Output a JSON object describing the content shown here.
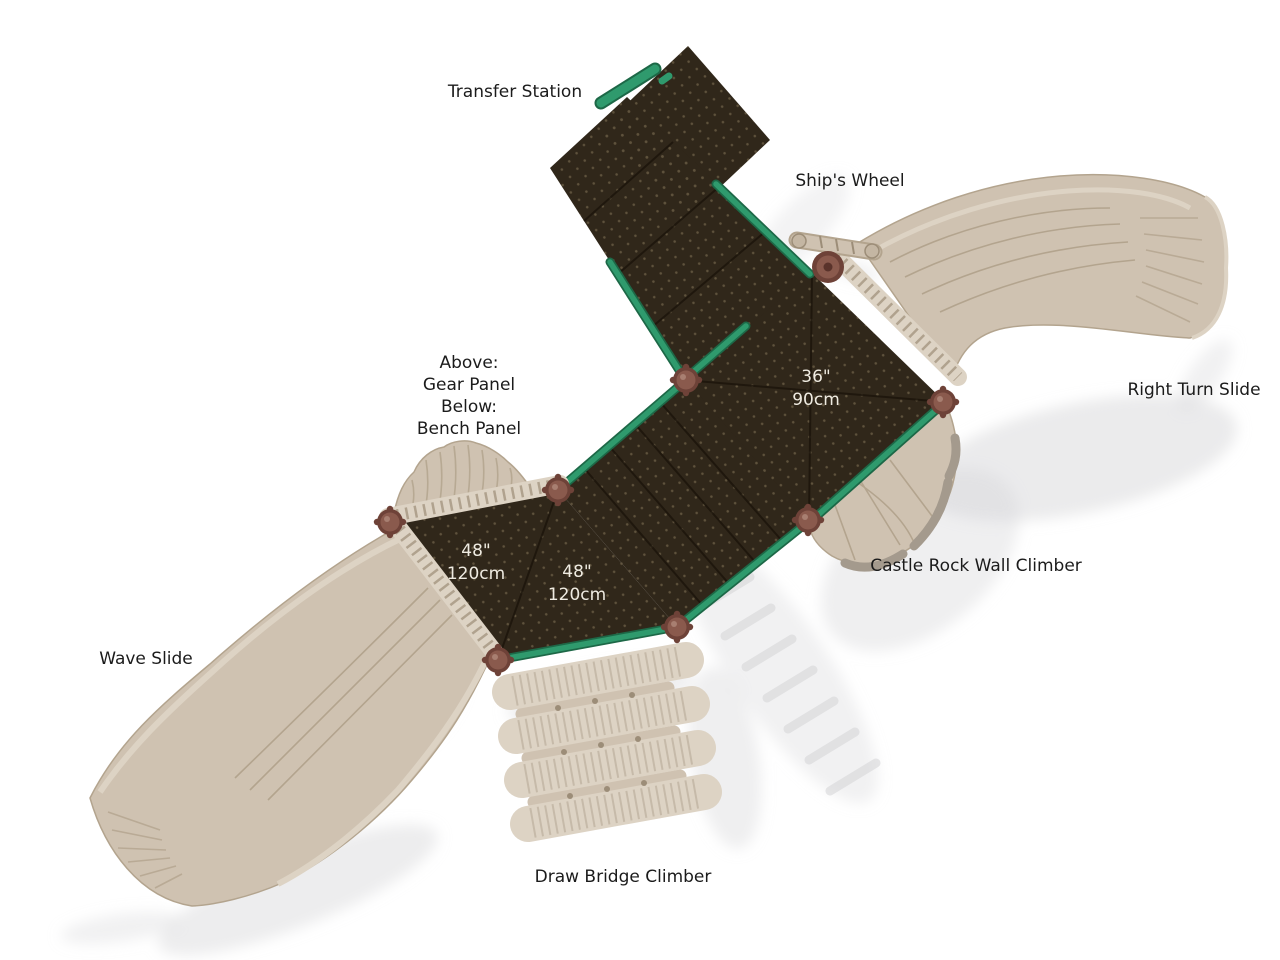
{
  "image": {
    "width": 1280,
    "height": 960,
    "background": "#ffffff",
    "description": "Top view diagram of a playground play system with labeled components"
  },
  "labels": {
    "transfer_station": "Transfer Station",
    "ships_wheel": "Ship's Wheel",
    "right_turn_slide": "Right Turn Slide",
    "castle_rock_climber": "Castle Rock Wall Climber",
    "wave_slide": "Wave Slide",
    "draw_bridge_climber": "Draw Bridge Climber",
    "panel_note": {
      "line1": "Above:",
      "line2": "Gear Panel",
      "line3": "Below:",
      "line4": "Bench Panel"
    }
  },
  "deck_dimensions": {
    "deck_36": {
      "imperial": "36\"",
      "metric": "90cm"
    },
    "deck_48_left": {
      "imperial": "48\"",
      "metric": "120cm"
    },
    "deck_48_right": {
      "imperial": "48\"",
      "metric": "120cm"
    }
  },
  "colors": {
    "background": "#ffffff",
    "deck": "#30271a",
    "deck_dot": "#8d7d5f",
    "deck_seam": "#1c150c",
    "edge_green": "#2f9a6d",
    "edge_green_dark": "#1d6847",
    "plastic_tan": "#cfc2b1",
    "plastic_tan_light": "#ddd3c4",
    "plastic_tan_dark": "#b3a48e",
    "plastic_outline": "#9c8d78",
    "rock_gray": "#a49a8d",
    "post_brown": "#6e4238",
    "post_brown_light": "#8a5a4d",
    "shadow": "#d8d8da",
    "label_text": "#1b1b1b",
    "dim_text": "#efebe1"
  }
}
